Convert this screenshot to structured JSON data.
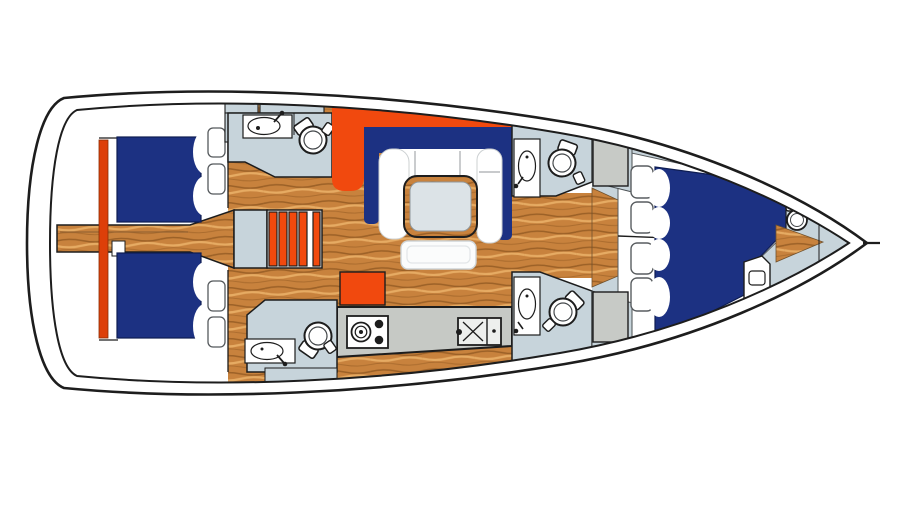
{
  "figure": {
    "type": "yacht-interior-floor-plan",
    "orientation": "bow-right-stern-left",
    "visible_text": []
  },
  "palette": {
    "outline": "#1d1d1d",
    "navy": "#1c3182",
    "orange": "#f1490e",
    "orange_dark": "#dd3f09",
    "cabinet_blue": "#c7d4db",
    "cabinet_gray": "#c7cac6",
    "counter_gray": "#c6c9c5",
    "wood_base": "#c8823d",
    "wood_dark": "#9c6127",
    "wood_light": "#e6ab63",
    "table_top": "#dce3e7",
    "white": "#ffffff"
  },
  "components": {
    "hull": "sailboat-hull-outline",
    "aft_cabin": [
      "port-berth-mattress",
      "starboard-berth-mattress",
      "center-walkway",
      "headboard-panel",
      "storage-shelves"
    ],
    "aft_heads": [
      "port-head-sink",
      "port-head-toilet",
      "starboard-head-sink",
      "starboard-head-toilet"
    ],
    "companionway": [
      "landing",
      "stairs"
    ],
    "salon": [
      "u-shaped-settee",
      "settee-backrest",
      "dining-table",
      "bench-seat"
    ],
    "galley": [
      "counter",
      "stove",
      "double-sink",
      "refrigerator-block"
    ],
    "mid_heads": [
      "port-head-sink",
      "port-head-toilet",
      "starboard-head-sink",
      "starboard-head-toilet"
    ],
    "forward_cabin": [
      "v-berth-mattress",
      "pillows",
      "storage-shelves",
      "cabinets"
    ],
    "bow": [
      "bow-head-toilet",
      "bow-sole-triangle",
      "seat-hatch",
      "anchor-locker"
    ]
  }
}
